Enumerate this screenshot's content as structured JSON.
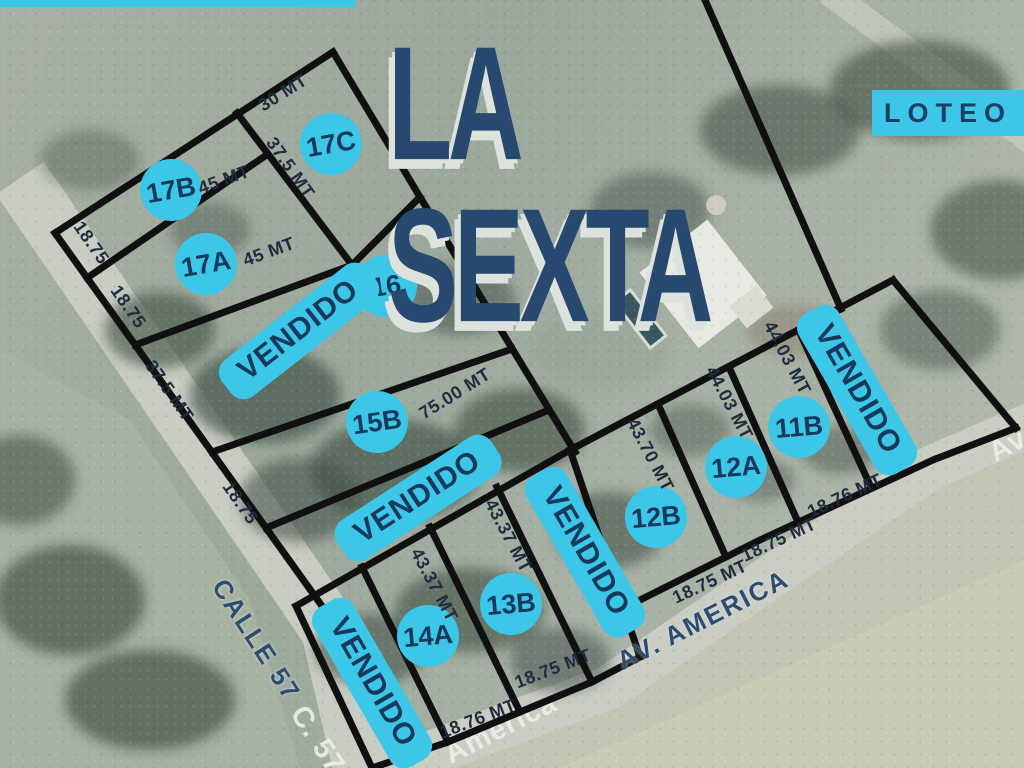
{
  "title": {
    "main": "LA SEXTA",
    "tag": "LOTEO"
  },
  "legend": {
    "sold_label": "VENDIDO"
  },
  "colors": {
    "accent_cyan": "#3cc7e8",
    "navy": "#16395c",
    "title_navy": "#27496f",
    "line_black": "#101010"
  },
  "lots": [
    {
      "id": "17B",
      "x": 171,
      "y": 190,
      "rot": -10
    },
    {
      "id": "17C",
      "x": 331,
      "y": 144,
      "rot": -10
    },
    {
      "id": "17A",
      "x": 206,
      "y": 264,
      "rot": -10
    },
    {
      "id": "16",
      "x": 386,
      "y": 286,
      "rot": -8
    },
    {
      "id": "15B",
      "x": 377,
      "y": 422,
      "rot": -8
    },
    {
      "id": "14A",
      "x": 428,
      "y": 636,
      "rot": -5
    },
    {
      "id": "13B",
      "x": 511,
      "y": 604,
      "rot": -5
    },
    {
      "id": "12B",
      "x": 656,
      "y": 517,
      "rot": -5
    },
    {
      "id": "12A",
      "x": 736,
      "y": 467,
      "rot": -5
    },
    {
      "id": "11B",
      "x": 799,
      "y": 427,
      "rot": -5
    }
  ],
  "sold_pills": [
    {
      "near": "lot-16",
      "x": 299,
      "y": 331,
      "rot": -38
    },
    {
      "near": "lot-15a",
      "x": 418,
      "y": 498,
      "rot": -33
    },
    {
      "near": "lot-14b",
      "x": 372,
      "y": 683,
      "rot": 60
    },
    {
      "near": "lot-13a",
      "x": 585,
      "y": 552,
      "rot": 60
    },
    {
      "near": "lot-11a",
      "x": 857,
      "y": 390,
      "rot": 60
    }
  ],
  "measurements": [
    {
      "text": "30 MT",
      "x": 283,
      "y": 93,
      "rot": -32
    },
    {
      "text": "37.5 MT",
      "x": 290,
      "y": 168,
      "rot": 55
    },
    {
      "text": "45 MT",
      "x": 224,
      "y": 180,
      "rot": -20
    },
    {
      "text": "18.75",
      "x": 91,
      "y": 243,
      "rot": 55
    },
    {
      "text": "45 MT",
      "x": 269,
      "y": 252,
      "rot": -20
    },
    {
      "text": "18.75",
      "x": 128,
      "y": 307,
      "rot": 55
    },
    {
      "text": "37.5 MT",
      "x": 169,
      "y": 391,
      "rot": 55
    },
    {
      "text": "75.00 MT",
      "x": 455,
      "y": 394,
      "rot": -32
    },
    {
      "text": "18.75",
      "x": 240,
      "y": 503,
      "rot": 55
    },
    {
      "text": "43.37 MT",
      "x": 434,
      "y": 585,
      "rot": 62
    },
    {
      "text": "43.37 MT",
      "x": 508,
      "y": 536,
      "rot": 62
    },
    {
      "text": "43.70 MT",
      "x": 650,
      "y": 455,
      "rot": 62
    },
    {
      "text": "44.03 MT",
      "x": 729,
      "y": 403,
      "rot": 62
    },
    {
      "text": "44.03 MT",
      "x": 787,
      "y": 358,
      "rot": 62
    },
    {
      "text": "18.76 MT",
      "x": 478,
      "y": 719,
      "rot": -21
    },
    {
      "text": "18.75 MT",
      "x": 553,
      "y": 669,
      "rot": -21
    },
    {
      "text": "18.75 MT",
      "x": 710,
      "y": 582,
      "rot": -25
    },
    {
      "text": "18.75 MT",
      "x": 779,
      "y": 540,
      "rot": -25
    },
    {
      "text": "18.76 MT",
      "x": 845,
      "y": 496,
      "rot": -25
    }
  ],
  "roads": [
    {
      "name": "CALLE 57",
      "x": 256,
      "y": 640,
      "rot": 57,
      "style": "overlay"
    },
    {
      "name": "AV. AMERICA",
      "x": 703,
      "y": 620,
      "rot": -27,
      "style": "overlay"
    },
    {
      "name": "C. 57",
      "x": 317,
      "y": 740,
      "rot": 57,
      "style": "base"
    },
    {
      "name": "América",
      "x": 501,
      "y": 729,
      "rot": -27,
      "style": "base"
    },
    {
      "name": "Av",
      "x": 1008,
      "y": 446,
      "rot": -28,
      "style": "base"
    }
  ]
}
